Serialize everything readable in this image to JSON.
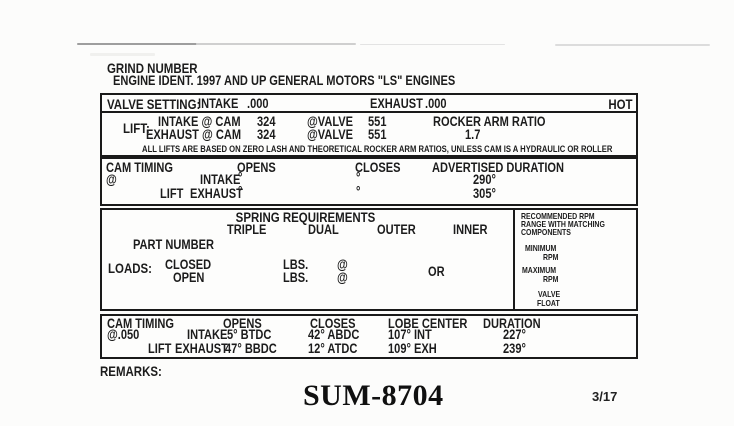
{
  "header": {
    "grind_number_label": "GRIND NUMBER",
    "engine_ident": "ENGINE IDENT. 1997 AND UP GENERAL MOTORS \"LS\" ENGINES"
  },
  "valve_setting": {
    "label": "VALVE SETTING:",
    "intake_label": "INTAKE",
    "intake_value": ".000",
    "exhaust_label": "EXHAUST",
    "exhaust_value": ".000",
    "temp": "HOT"
  },
  "lift": {
    "label": "LIFT:",
    "intake_cam_label": "INTAKE @ CAM",
    "intake_cam_value": "324",
    "at_valve_label": "@VALVE",
    "intake_valve_value": "551",
    "exhaust_cam_label": "EXHAUST @ CAM",
    "exhaust_cam_value": "324",
    "exhaust_valve_value": "551",
    "rocker_ratio_label": "ROCKER ARM RATIO",
    "rocker_ratio_value": "1.7",
    "disclaimer": "ALL LIFTS ARE BASED ON ZERO LASH AND THEORETICAL ROCKER ARM RATIOS, UNLESS CAM IS A HYDRAULIC OR ROLLER"
  },
  "cam_timing_advertised": {
    "heading": "CAM TIMING",
    "at_symbol": "@",
    "lift_label": "LIFT",
    "opens_label": "OPENS",
    "closes_label": "CLOSES",
    "duration_label": "ADVERTISED DURATION",
    "intake_label": "INTAKE",
    "exhaust_label": "EXHAUST",
    "intake_opens": "°",
    "intake_closes": "°",
    "intake_duration": "290°",
    "exhaust_opens": "°",
    "exhaust_closes": "°",
    "exhaust_duration": "305°"
  },
  "spring": {
    "title": "SPRING REQUIREMENTS",
    "columns": [
      "TRIPLE",
      "DUAL",
      "OUTER",
      "INNER"
    ],
    "part_number_label": "PART NUMBER",
    "loads_label": "LOADS:",
    "closed_label": "CLOSED",
    "open_label": "OPEN",
    "lbs_label": "LBS.",
    "at_symbol": "@",
    "or_label": "OR",
    "rpm_panel": {
      "heading_line1": "RECOMMENDED RPM",
      "heading_line2": "RANGE WITH MATCHING",
      "heading_line3": "COMPONENTS",
      "minimum_label": "MINIMUM",
      "minimum_rpm": "RPM",
      "maximum_label": "MAXIMUM",
      "maximum_rpm": "RPM",
      "valve_float_line1": "VALVE",
      "valve_float_line2": "FLOAT"
    }
  },
  "cam_timing_050": {
    "heading": "CAM TIMING",
    "at_lift_value": "@.050",
    "lift_label": "LIFT",
    "opens_label": "OPENS",
    "closes_label": "CLOSES",
    "lobe_center_label": "LOBE CENTER",
    "duration_label": "DURATION",
    "intake_label": "INTAKE",
    "exhaust_label": "EXHAUST",
    "intake_opens": "5° BTDC",
    "intake_closes": "42° ABDC",
    "intake_lobe_center": "107° INT",
    "intake_duration": "227°",
    "exhaust_opens": "47° BBDC",
    "exhaust_closes": "12° ATDC",
    "exhaust_lobe_center": "109° EXH",
    "exhaust_duration": "239°"
  },
  "footer": {
    "remarks_label": "REMARKS:",
    "part_number": "SUM-8704",
    "page_ref": "3/17"
  }
}
